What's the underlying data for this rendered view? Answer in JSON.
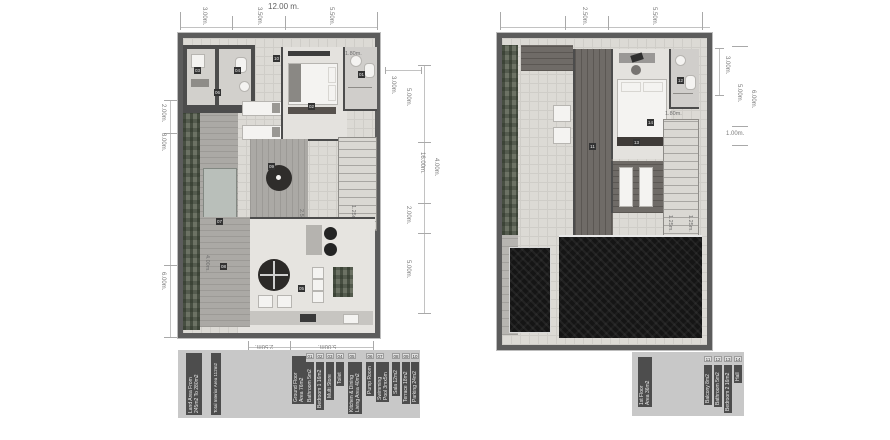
{
  "ground": {
    "dims": {
      "top_overall": "12.00 m.",
      "top": [
        "3.00m.",
        "3.50m.",
        "5.50m."
      ],
      "left": [
        "2.00m.",
        "8.00m.",
        "6.00m."
      ],
      "right": [
        "5.00m.",
        "4.00m.",
        "2.00m.",
        "5.00m."
      ],
      "right_overall": "16.00m.",
      "right_block": "3.00m.",
      "bottom": [
        "2.50m.",
        "5.00m."
      ],
      "interior": {
        "bath": "1.80m.",
        "sala": "4.00m.",
        "deck": "2.50m.",
        "stairs": "1.25m."
      }
    },
    "markers": [
      "01",
      "02",
      "03",
      "04",
      "05",
      "06",
      "07",
      "08",
      "09",
      "10"
    ]
  },
  "first": {
    "dims": {
      "top": [
        "2.50m.",
        "5.50m."
      ],
      "right_block": "3.00m.",
      "right": [
        "5.00m.",
        "1.00m."
      ],
      "right_overall": "6.00m.",
      "interior": {
        "bath": "1.80m.",
        "stairs_a": "1.25m.",
        "stairs_b": "1.25m."
      }
    },
    "markers": [
      "11",
      "12",
      "13",
      "14"
    ]
  },
  "legend_ground": {
    "summary": [
      {
        "lines": [
          "Land Area From",
          "245m2 To 280m2"
        ]
      },
      {
        "lines": [
          "Total Interior Area 112m2"
        ]
      },
      {
        "lines": [
          "Ground Floor",
          "Area 76m2"
        ]
      }
    ],
    "items": [
      {
        "num": "01",
        "lines": [
          "Bathroom 5m2"
        ]
      },
      {
        "num": "02",
        "lines": [
          "Bedroom 1 16m2"
        ]
      },
      {
        "num": "03",
        "lines": [
          "Multi Store"
        ]
      },
      {
        "num": "04",
        "lines": [
          "Toilet"
        ]
      },
      {
        "num": "05",
        "lines": [
          "Kitchen & Dining",
          "Living Area 40m2"
        ]
      },
      {
        "num": "06",
        "lines": [
          "Pump Room"
        ]
      },
      {
        "num": "07",
        "lines": [
          "Swimming",
          "Pool 3mx5m"
        ]
      },
      {
        "num": "08",
        "lines": [
          "Sala 12m2"
        ]
      },
      {
        "num": "09",
        "lines": [
          "Terrace 18m2"
        ]
      },
      {
        "num": "10",
        "lines": [
          "Parking 24m2"
        ]
      }
    ]
  },
  "legend_first": {
    "summary": [
      {
        "lines": [
          "1st Floor",
          "Area 36m2"
        ]
      }
    ],
    "items": [
      {
        "num": "11",
        "lines": [
          "Balcony 8m2"
        ]
      },
      {
        "num": "12",
        "lines": [
          "Bathroom 5m2"
        ]
      },
      {
        "num": "13",
        "lines": [
          "Bedroom 2 16m2"
        ]
      },
      {
        "num": "14",
        "lines": [
          "Hall"
        ]
      }
    ]
  }
}
